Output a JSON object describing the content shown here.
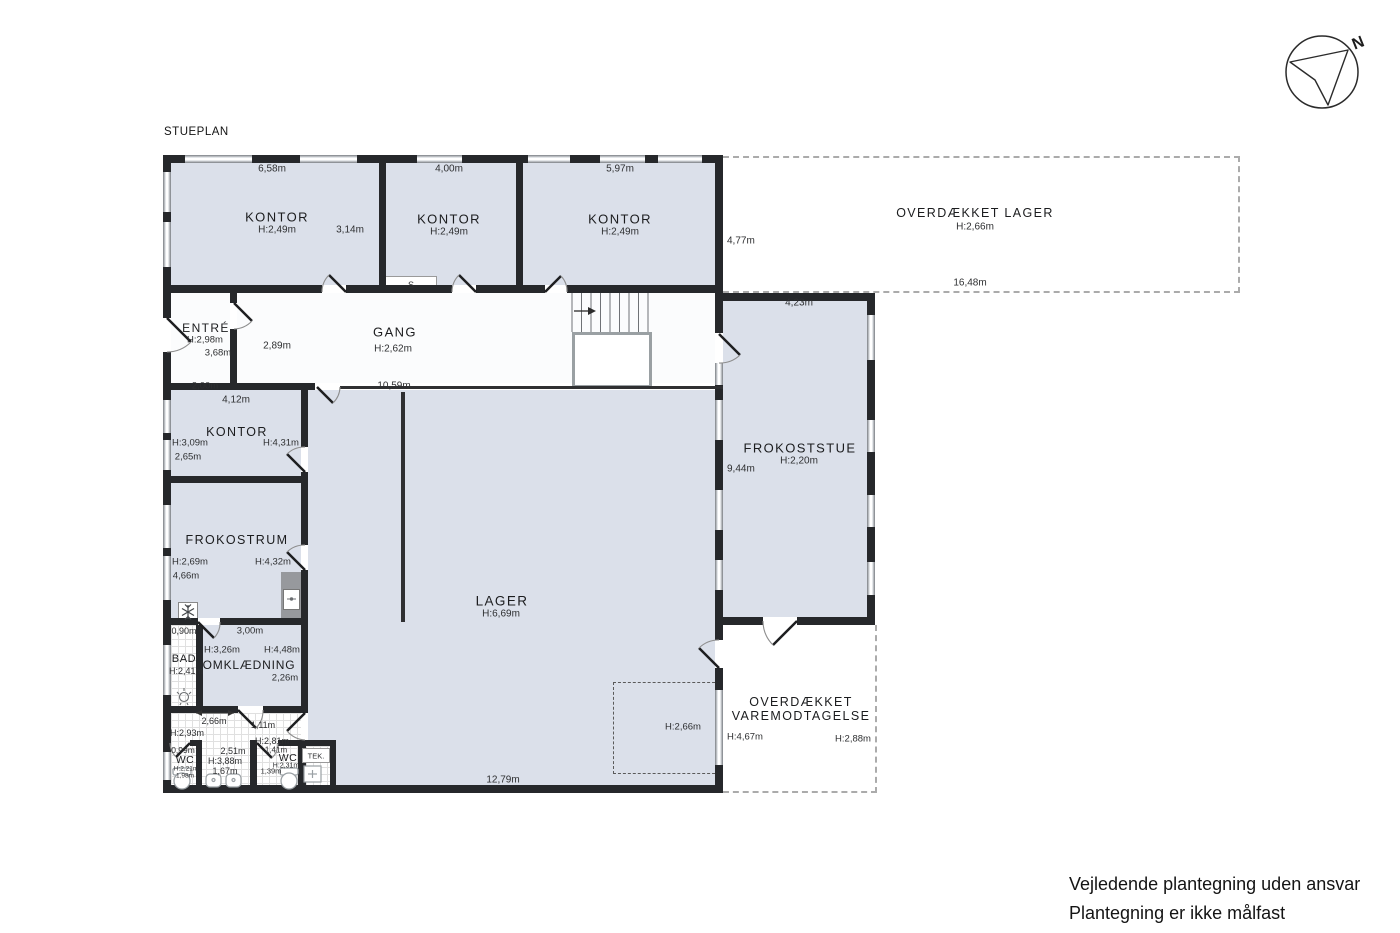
{
  "title": "STUEPLAN",
  "compass": {
    "label": "N"
  },
  "rooms": {
    "kontor1": {
      "name": "KONTOR",
      "height": "H:2,49m",
      "width": "6,58m",
      "side": "3,14m"
    },
    "kontor2": {
      "name": "KONTOR",
      "height": "H:2,49m",
      "width": "4,00m",
      "closet": "S"
    },
    "kontor3": {
      "name": "KONTOR",
      "height": "H:2,49m",
      "width": "5,97m"
    },
    "overdaekket_lager": {
      "name": "OVERDÆKKET LAGER",
      "height": "H:2,66m",
      "width": "16,48m",
      "side": "4,77m"
    },
    "entre": {
      "name": "ENTRÉ",
      "height": "H:2,98m",
      "dim_a": "3,68m",
      "dim_b": "2,00m"
    },
    "gang": {
      "name": "GANG",
      "height": "H:2,62m",
      "dim_a": "2,89m",
      "dim_b": "10,59m"
    },
    "frokoststue": {
      "name": "FROKOSTSTUE",
      "height": "H:2,20m",
      "width": "4,23m",
      "side": "9,44m"
    },
    "kontor4": {
      "name": "KONTOR",
      "height": "H:3,09m",
      "width": "4,12m",
      "dim_a": "2,65m",
      "dim_b": "H:4,31m"
    },
    "frokostrum": {
      "name": "FROKOSTRUM",
      "height": "H:2,69m",
      "dim_a": "4,66m",
      "dim_b": "H:4,32m"
    },
    "bad": {
      "name": "BAD",
      "height": "H:2,41m",
      "width": "0,90m"
    },
    "omklaedning": {
      "name": "OMKLÆDNING",
      "height_a": "H:3,26m",
      "height_b": "H:4,48m",
      "width": "3,00m",
      "dim": "2,26m"
    },
    "forrum": {
      "dim_a": "2,66m",
      "height_a": "H:2,93m",
      "dim_b": "1,11m",
      "dim_c": "2,51m",
      "height_b": "H:2,81m",
      "dim_d": "1,41m"
    },
    "wc_left": {
      "name": "WC",
      "width": "0,99m",
      "height": "H:2,21m",
      "dim": "1,98m"
    },
    "wc_mid": {
      "height": "H:3,88m",
      "dim": "1,67m"
    },
    "wc_right": {
      "name": "WC",
      "height": "H:2,31m",
      "dim": "1,39m"
    },
    "teknik": {
      "name": "TEK."
    },
    "lager": {
      "name": "LAGER",
      "height": "H:6,69m",
      "width": "12,79m",
      "mezzanine_height": "H:2,66m"
    },
    "varemodtagelse": {
      "name_line1": "OVERDÆKKET",
      "name_line2": "VAREMODTAGELSE",
      "height_a": "H:4,67m",
      "height_b": "H:2,88m"
    }
  },
  "footer": {
    "line1": "Vejledende plantegning uden ansvar",
    "line2": "Plantegning er ikke målfast"
  },
  "colors": {
    "wall": "#26282b",
    "room_fill": "#dbe0ea",
    "corridor_fill": "#fbfcfd",
    "dashed_outline": "#ababab"
  }
}
